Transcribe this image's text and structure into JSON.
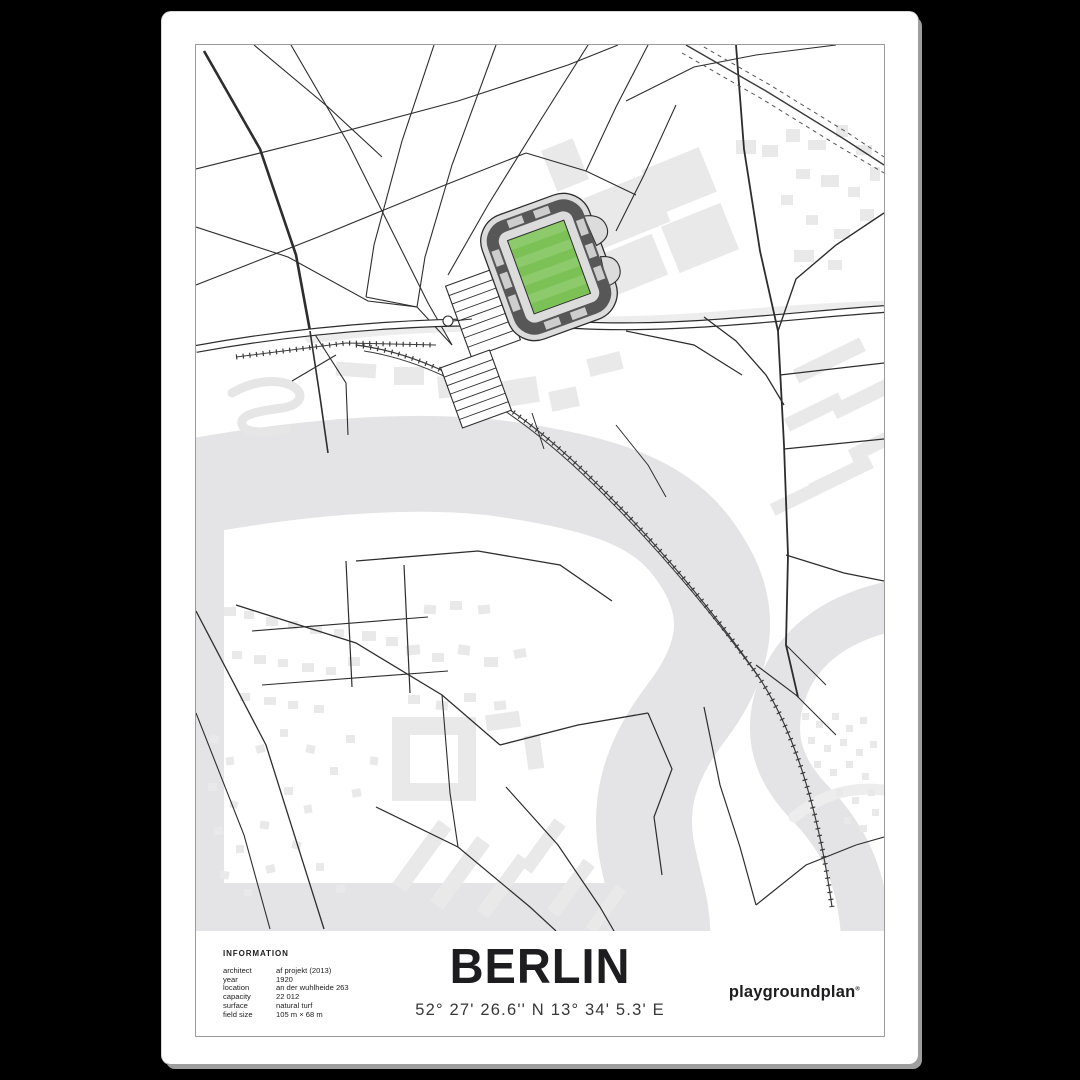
{
  "poster": {
    "title": "BERLIN",
    "coordinates": "52° 27' 26.6'' N  13° 34' 5.3' E",
    "brand": "playgroundplan",
    "brand_mark": "®"
  },
  "information": {
    "heading": "INFORMATION",
    "rows": [
      {
        "label": "architect",
        "value": "af projekt (2013)"
      },
      {
        "label": "year",
        "value": "1920"
      },
      {
        "label": "location",
        "value": "an der wuhlheide 263"
      },
      {
        "label": "capacity",
        "value": "22 012"
      },
      {
        "label": "surface",
        "value": "natural turf"
      },
      {
        "label": "field size",
        "value": "105 m × 68 m"
      }
    ]
  },
  "map": {
    "features": {
      "stadium": "stadium-with-green-pitch",
      "river": "river-band",
      "railway": "railway-with-sleepers",
      "parking": "parking-lot-grid",
      "buildings": "light-gray-building-footprints"
    }
  },
  "colors": {
    "background": "#000000",
    "paper": "#ffffff",
    "frame_line": "#9b9b9b",
    "map_line": "#2d2d2d",
    "water": "#e4e4e6",
    "building": "#e9e9e9",
    "stand_dark": "#575757",
    "stand_light": "#cdcdcd",
    "concourse": "#dcdcdc",
    "pitch_light": "#8cca6b",
    "pitch_dark": "#7cc156",
    "text_dark": "#1d1d1f",
    "text_mid": "#38383a"
  }
}
